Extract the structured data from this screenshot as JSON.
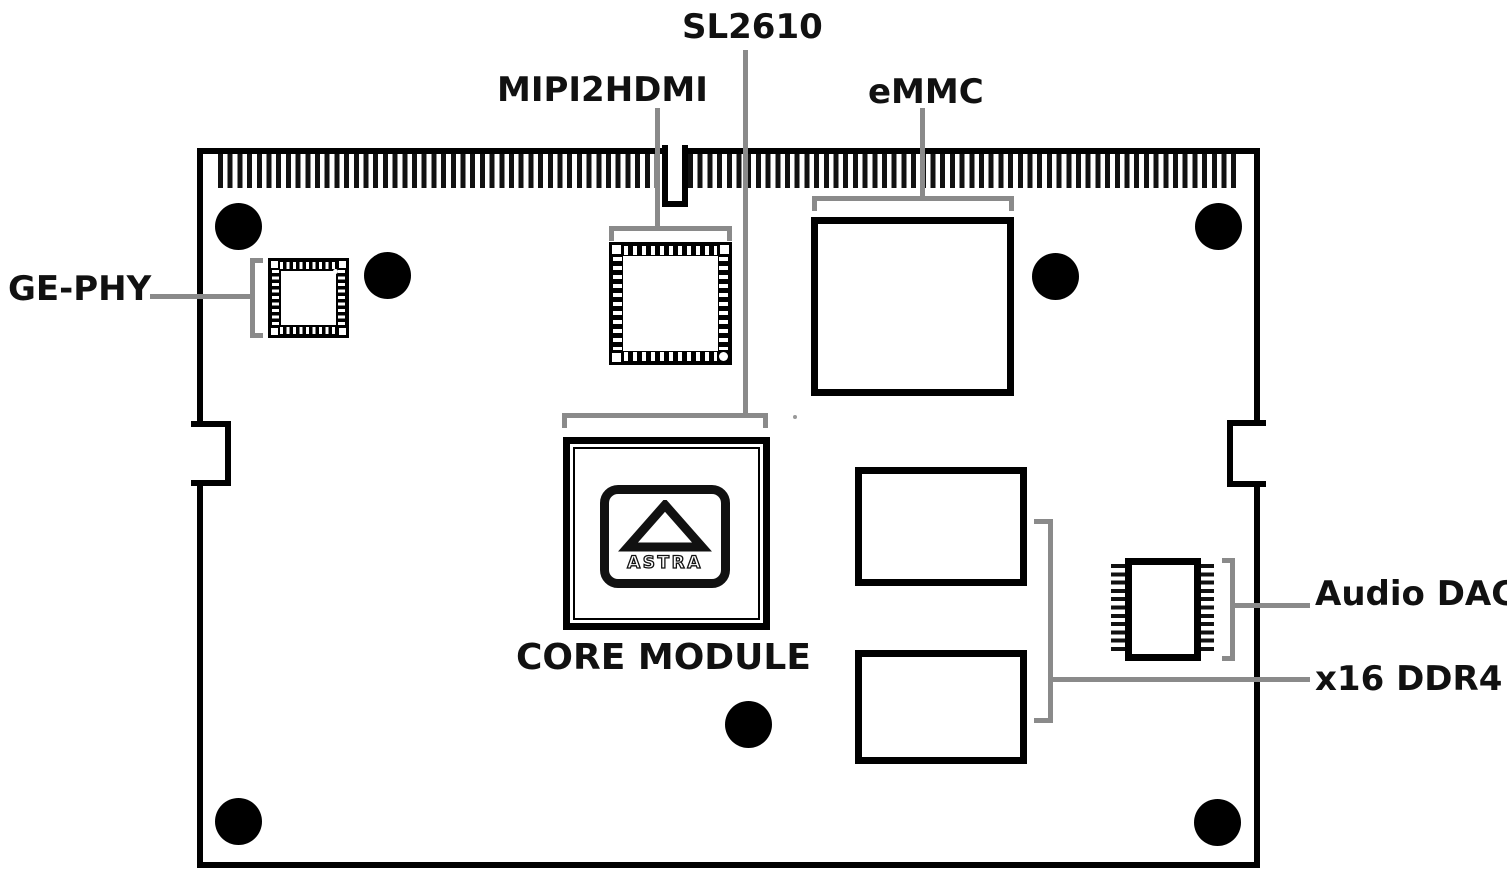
{
  "colors": {
    "ink": "#111111",
    "leader_gray": "#8a8a8a",
    "board_outline": "#000000",
    "board_bg": "#ffffff"
  },
  "labels": {
    "sl2610": "SL2610",
    "mipi2hdmi": "MIPI2HDMI",
    "emmc": "eMMC",
    "ge_phy": "GE-PHY",
    "core_module": "CORE MODULE",
    "audio_dac": "Audio DAC",
    "ddr4": "x16 DDR4"
  },
  "core_chip": {
    "logo_text": "ASTRA"
  }
}
